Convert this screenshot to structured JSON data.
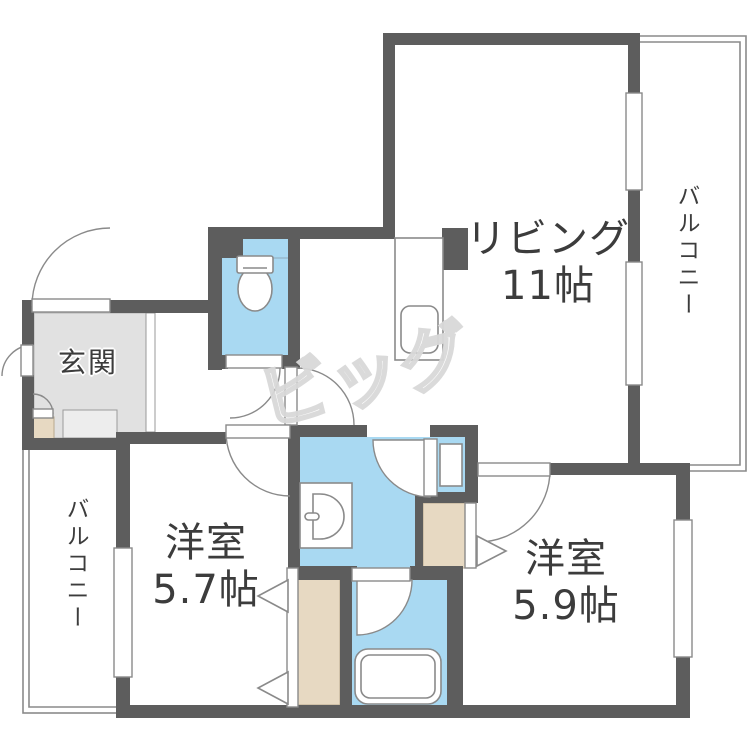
{
  "floorplan": {
    "watermark": "ビッグ",
    "labels": {
      "living": {
        "name": "リビング",
        "size": "11帖"
      },
      "bedroom_57": {
        "name": "洋室",
        "size": "5.7帖"
      },
      "bedroom_59": {
        "name": "洋室",
        "size": "5.9帖"
      },
      "entrance": {
        "name": "玄関"
      },
      "balcony_right": {
        "name": "バルコニー"
      },
      "balcony_left": {
        "name": "バルコニー"
      }
    },
    "fixtures": [
      "toilet",
      "kitchen-sink",
      "washbasin",
      "washing-machine-pan",
      "bathtub"
    ],
    "colors": {
      "wall": "#5d5d5d",
      "water": "#a9d9f2",
      "closet": "#e7d9c2",
      "entrance_floor": "#e1e1e1",
      "line": "#8a8a8a",
      "text": "#3c3c3c",
      "watermark": "#d9d9d9"
    }
  }
}
